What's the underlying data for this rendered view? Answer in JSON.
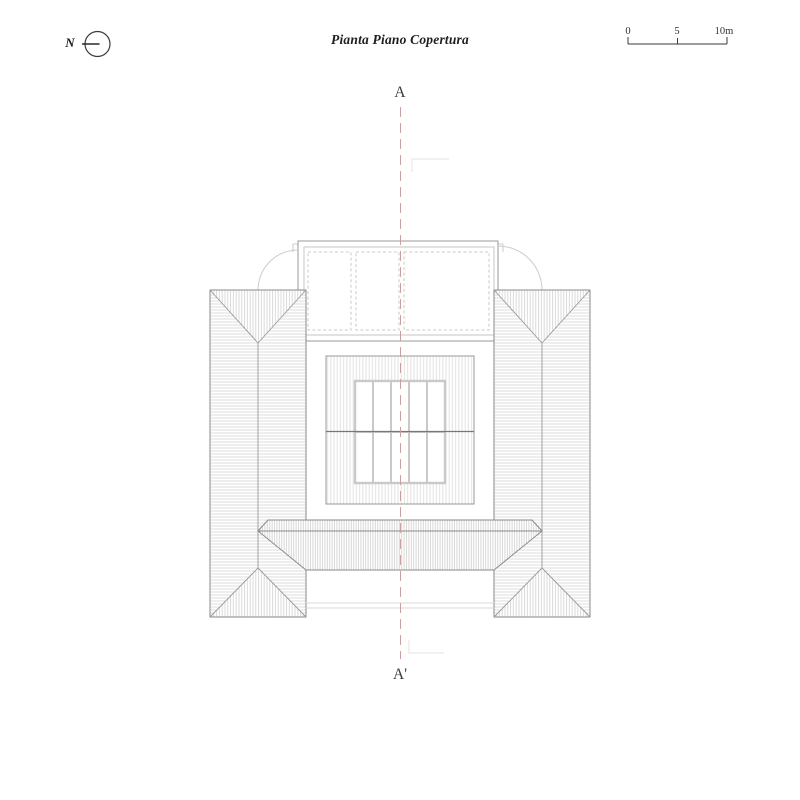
{
  "title": "Pianta Piano Copertura",
  "north": {
    "label": "N"
  },
  "scale_bar": {
    "tick0": "0",
    "tick5": "5",
    "tick10": "10m",
    "length_label": "10m"
  },
  "section": {
    "top": "A",
    "bottom": "A'"
  },
  "colors": {
    "background": "#ffffff",
    "outline": "#8a8a8a",
    "dark_line": "#3a3a3a",
    "hatch": "#d8d8d8",
    "light_frame": "#c9c9c9",
    "section_line": "#c9a0a0",
    "ridge": "#777777"
  },
  "drawing": {
    "kind": "roof plan",
    "skylight_grid": {
      "columns": 5,
      "rows": 2
    }
  }
}
